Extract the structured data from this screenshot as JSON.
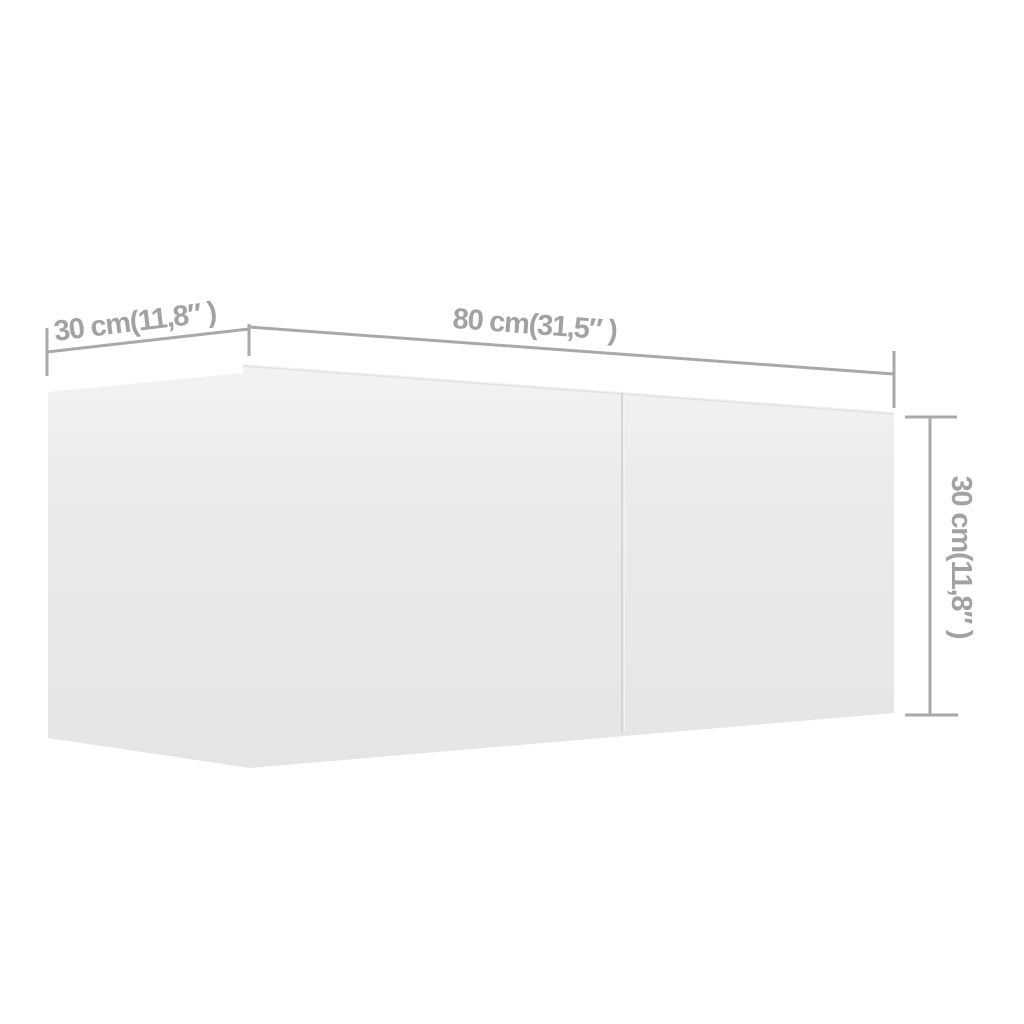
{
  "diagram": {
    "kind": "product-dimension-diagram",
    "subject": "wall-mounted cabinet shown in 3D perspective with measurement lines",
    "dimensions": {
      "depth": {
        "label": "30 cm(11,8″ )",
        "cm": "30",
        "inches": "11,8″"
      },
      "width": {
        "label": "80 cm(31,5″ )",
        "cm": "80",
        "inches": "31,5″"
      },
      "height": {
        "label": "30 cm(11,8″ )",
        "cm": "30",
        "inches": "11,8″"
      }
    },
    "colors": {
      "background": "#ffffff",
      "dimension_line": "#a9a9a9",
      "dimension_text": "#a2a2a2",
      "face_top": "#f3f3f4",
      "face_mid": "#ebebec",
      "face_bottom": "#e5e5e6",
      "front_top_edge": "#e2e2e3",
      "seam": "#d6d6d7",
      "seam_highlight": "#f2f2f3"
    }
  }
}
